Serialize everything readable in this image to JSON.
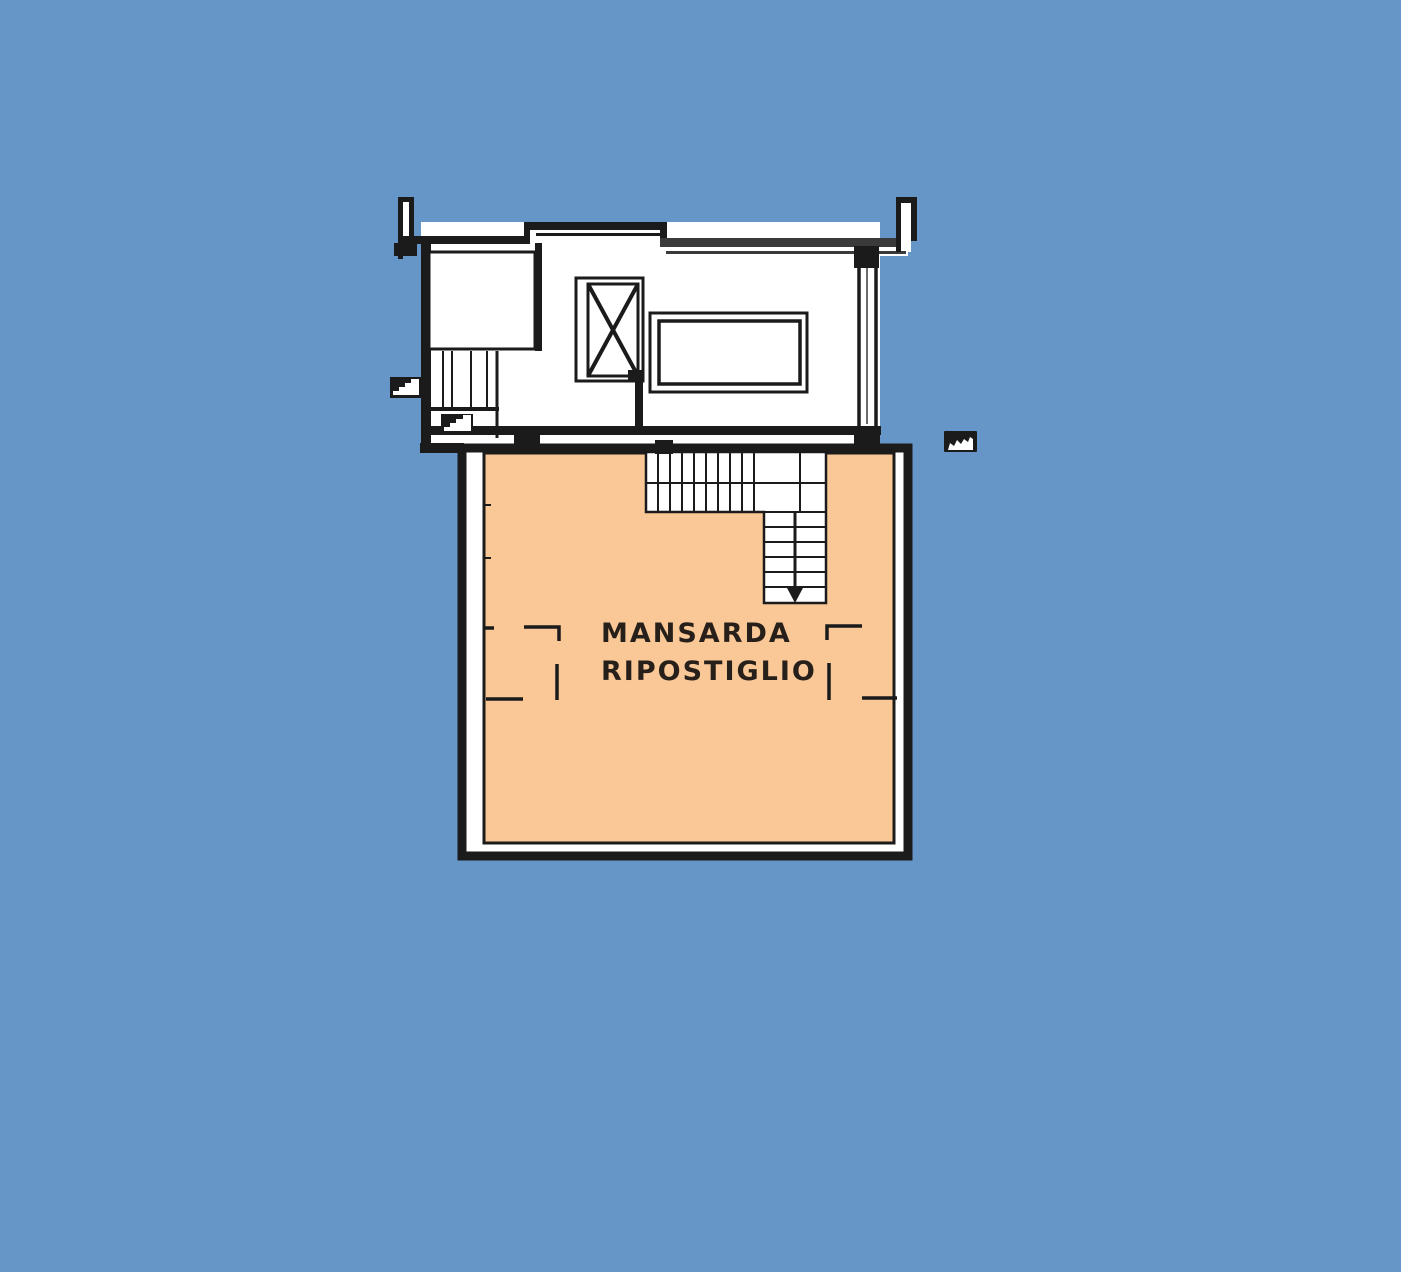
{
  "plan": {
    "room_label": {
      "line1": "MANSARDA",
      "line2": "RIPOSTIGLIO"
    }
  },
  "colors": {
    "background": "#6696c8",
    "plan_fill": "#ffffff",
    "room_fill": "#f9c896",
    "wall": "#1b1b1b",
    "wall_secondary": "#3a3a3a",
    "label_text": "#27201a"
  },
  "icons": {
    "elevator_shaft": "x-crossed-rectangle",
    "stair_direction": "down-arrow-triangle",
    "exterior_steps": "step-profile",
    "small_steps": "step-profile",
    "plan_marker": "black-rect-white-blob"
  }
}
